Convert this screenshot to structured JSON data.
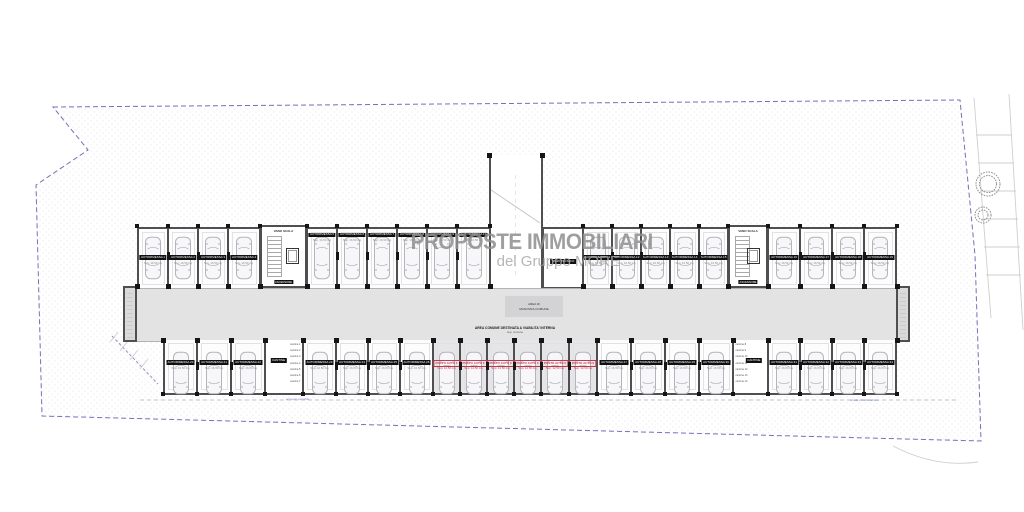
{
  "watermark": {
    "line1": "PROPOSTE IMMOBILIARI",
    "line2": "del Gruppo MORE"
  },
  "palette": {
    "wall": "#4f4f4f",
    "pillar": "#151515",
    "corridor": "#e3e3e4",
    "posto_auto_red": "#c2374b",
    "boundary_dash": "#7272b8",
    "watermark_gray": "#8f8f8f"
  },
  "corridor": {
    "box_line1": "AREA DI",
    "box_line2": "MANOVRA COMUNE",
    "note_line1": "AREA COMUNE DESTINATA A VIABILITA' INTERNA",
    "note_line2": "sup. comune"
  },
  "cores": {
    "left": {
      "label": "VANO SCALA",
      "lift_label": "ASCENSORE"
    },
    "right": {
      "label": "VANO SCALA",
      "lift_label": "ASCENSORE"
    }
  },
  "tech_room": {
    "label": "VANO TECNICO"
  },
  "storages": {
    "left": {
      "label": "CANTINE",
      "lines": [
        "cantina 1",
        "cantina 2",
        "cantina 3",
        "cantina 4",
        "cantina 5",
        "cantina 6",
        "cantina 7"
      ]
    },
    "right": {
      "label": "CANTINE",
      "lines": [
        "cantina 8",
        "cantina 9",
        "cantina 10",
        "cantina 11",
        "cantina 12",
        "cantina 13",
        "cantina 14"
      ]
    }
  },
  "site_notes": {
    "left": "accesso carrabile",
    "right": "strada di lottizzazione"
  },
  "garage_rows": {
    "top": [
      {
        "bounds": [
          137,
          168,
          198,
          228,
          260
        ],
        "label_pos": "mid",
        "stalls": [
          {
            "label": "AUTORIMESSA 1",
            "area": "Sup. 16,50 mq"
          },
          {
            "label": "AUTORIMESSA 2",
            "area": "Sup. 16,50 mq"
          },
          {
            "label": "AUTORIMESSA 3",
            "area": "Sup. 16,50 mq"
          },
          {
            "label": "AUTORIMESSA 4",
            "area": "Sup. 16,50 mq"
          }
        ]
      },
      {
        "bounds": [
          307,
          337,
          367,
          397,
          427,
          457,
          490
        ],
        "label_pos": "top",
        "stalls": [
          {
            "label": "AUTORIMESSA 5",
            "area": "Sup. 16,50 mq"
          },
          {
            "label": "AUTORIMESSA 6",
            "area": "Sup. 16,50 mq"
          },
          {
            "label": "AUTORIMESSA 7",
            "area": "Sup. 16,50 mq"
          },
          {
            "label": "AUTORIMESSA 8",
            "area": "Sup. 16,50 mq"
          },
          {
            "label": "AUTORIMESSA 9",
            "area": "Sup. 16,50 mq"
          },
          {
            "label": "AUTORIMESSA 10",
            "area": "Sup. 16,50 mq"
          }
        ]
      },
      {
        "bounds": [
          583,
          612,
          641,
          670,
          699,
          728
        ],
        "label_pos": "mid",
        "stalls": [
          {
            "label": "AUTORIMESSA 11",
            "area": "Sup. 16,50 mq"
          },
          {
            "label": "AUTORIMESSA 12",
            "area": "Sup. 16,50 mq"
          },
          {
            "label": "AUTORIMESSA 13",
            "area": "Sup. 16,50 mq"
          },
          {
            "label": "AUTORIMESSA 14",
            "area": "Sup. 16,50 mq"
          },
          {
            "label": "AUTORIMESSA 15",
            "area": "Sup. 16,50 mq"
          }
        ]
      },
      {
        "bounds": [
          768,
          800,
          832,
          864,
          897
        ],
        "label_pos": "mid",
        "stalls": [
          {
            "label": "AUTORIMESSA 16",
            "area": "Sup. 16,50 mq"
          },
          {
            "label": "AUTORIMESSA 17",
            "area": "Sup. 16,50 mq"
          },
          {
            "label": "AUTORIMESSA 18",
            "area": "Sup. 16,50 mq"
          },
          {
            "label": "AUTORIMESSA 19",
            "area": "Sup. 16,50 mq"
          }
        ]
      }
    ],
    "bottom": [
      {
        "bounds": [
          163,
          197,
          231,
          265
        ],
        "stalls": [
          {
            "label": "AUTORIMESSA 20",
            "area": "Sup. 16,50 mq"
          },
          {
            "label": "AUTORIMESSA 21",
            "area": "Sup. 16,50 mq"
          },
          {
            "label": "AUTORIMESSA 22",
            "area": "Sup. 16,50 mq"
          }
        ]
      },
      {
        "bounds": [
          303,
          336,
          368,
          400,
          433
        ],
        "stalls": [
          {
            "label": "AUTORIMESSA 23",
            "area": "Sup. 16,50 mq"
          },
          {
            "label": "AUTORIMESSA 24",
            "area": "Sup. 16,50 mq"
          },
          {
            "label": "AUTORIMESSA 25",
            "area": "Sup. 16,50 mq"
          },
          {
            "label": "AUTORIMESSA 26",
            "area": "Sup. 16,50 mq"
          }
        ]
      },
      {
        "bounds": [
          433,
          460,
          487,
          514,
          541,
          569,
          597
        ],
        "red": true,
        "stalls": [
          {
            "label": "POSTO AUTO 1",
            "area": "Sup. 12,50 mq"
          },
          {
            "label": "POSTO AUTO 2",
            "area": "Sup. 12,50 mq"
          },
          {
            "label": "POSTO AUTO 3",
            "area": "Sup. 12,50 mq"
          },
          {
            "label": "POSTO AUTO 4",
            "area": "Sup. 12,50 mq"
          },
          {
            "label": "POSTO AUTO 5",
            "area": "Sup. 12,50 mq"
          },
          {
            "label": "POSTO AUTO 6",
            "area": "Sup. 12,50 mq"
          }
        ]
      },
      {
        "bounds": [
          597,
          631,
          665,
          699,
          733
        ],
        "stalls": [
          {
            "label": "AUTORIMESSA 27",
            "area": "Sup. 16,50 mq"
          },
          {
            "label": "AUTORIMESSA 28",
            "area": "Sup. 16,50 mq"
          },
          {
            "label": "AUTORIMESSA 29",
            "area": "Sup. 16,50 mq"
          },
          {
            "label": "AUTORIMESSA 30",
            "area": "Sup. 16,50 mq"
          }
        ]
      },
      {
        "bounds": [
          768,
          800,
          832,
          864,
          897
        ],
        "stalls": [
          {
            "label": "AUTORIMESSA 31",
            "area": "Sup. 16,50 mq"
          },
          {
            "label": "AUTORIMESSA 32",
            "area": "Sup. 16,50 mq"
          },
          {
            "label": "AUTORIMESSA 33",
            "area": "Sup. 16,50 mq"
          },
          {
            "label": "AUTORIMESSA 34",
            "area": "Sup. 16,50 mq"
          }
        ]
      }
    ]
  }
}
